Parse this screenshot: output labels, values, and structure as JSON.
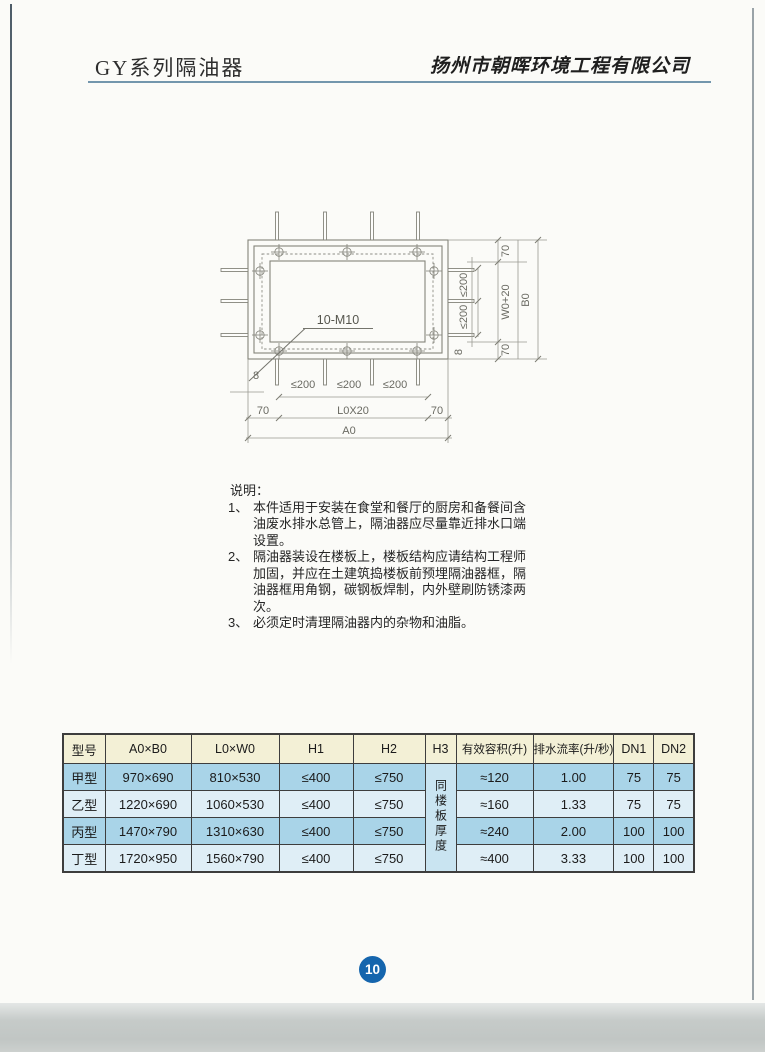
{
  "page": {
    "title": "GY系列隔油器",
    "company": "扬州市朝晖环境工程有限公司",
    "page_number": "10"
  },
  "diagram": {
    "bolt_label": "10-M10",
    "dims": {
      "le200": "≤200",
      "d8": "8",
      "d70": "70",
      "l0": "L0X20",
      "a0": "A0",
      "w0": "W0+20",
      "b0": "B0"
    }
  },
  "notes": {
    "heading": "说明：",
    "items": [
      {
        "marker": "1、",
        "lines": [
          "本件适用于安装在食堂和餐厅的厨房和备餐间含",
          "油废水排水总管上，隔油器应尽量靠近排水口端",
          "设置。"
        ]
      },
      {
        "marker": "2、",
        "lines": [
          "隔油器装设在楼板上，楼板结构应请结构工程师",
          "加固，并应在土建筑捣楼板前预埋隔油器框，隔",
          "油器框用角钢，碳钢板焊制，内外壁刷防锈漆两",
          "次。"
        ]
      },
      {
        "marker": "3、",
        "lines": [
          "必须定时清理隔油器内的杂物和油脂。"
        ]
      }
    ]
  },
  "table": {
    "headers": [
      "型号",
      "A0×B0",
      "L0×W0",
      "H1",
      "H2",
      "H3",
      "有效容积(升)",
      "排水流率(升/秒)",
      "DN1",
      "DN2"
    ],
    "h3_merged": "同楼板厚度",
    "rows": [
      {
        "model": "甲型",
        "a0b0": "970×690",
        "l0w0": "810×530",
        "h1": "≤400",
        "h2": "≤750",
        "volume": "≈120",
        "flow": "1.00",
        "dn1": "75",
        "dn2": "75"
      },
      {
        "model": "乙型",
        "a0b0": "1220×690",
        "l0w0": "1060×530",
        "h1": "≤400",
        "h2": "≤750",
        "volume": "≈160",
        "flow": "1.33",
        "dn1": "75",
        "dn2": "75"
      },
      {
        "model": "丙型",
        "a0b0": "1470×790",
        "l0w0": "1310×630",
        "h1": "≤400",
        "h2": "≤750",
        "volume": "≈240",
        "flow": "2.00",
        "dn1": "100",
        "dn2": "100"
      },
      {
        "model": "丁型",
        "a0b0": "1720×950",
        "l0w0": "1560×790",
        "h1": "≤400",
        "h2": "≤750",
        "volume": "≈400",
        "flow": "3.33",
        "dn1": "100",
        "dn2": "100"
      }
    ]
  },
  "colors": {
    "header_rule": "#7396ad",
    "table_header_bg": "#f3f0d6",
    "row_blue": "#a9d4e8",
    "row_light": "#dfeef6",
    "h3_cell_bg": "#c9e4f1",
    "page_badge_bg": "#1565ad"
  }
}
